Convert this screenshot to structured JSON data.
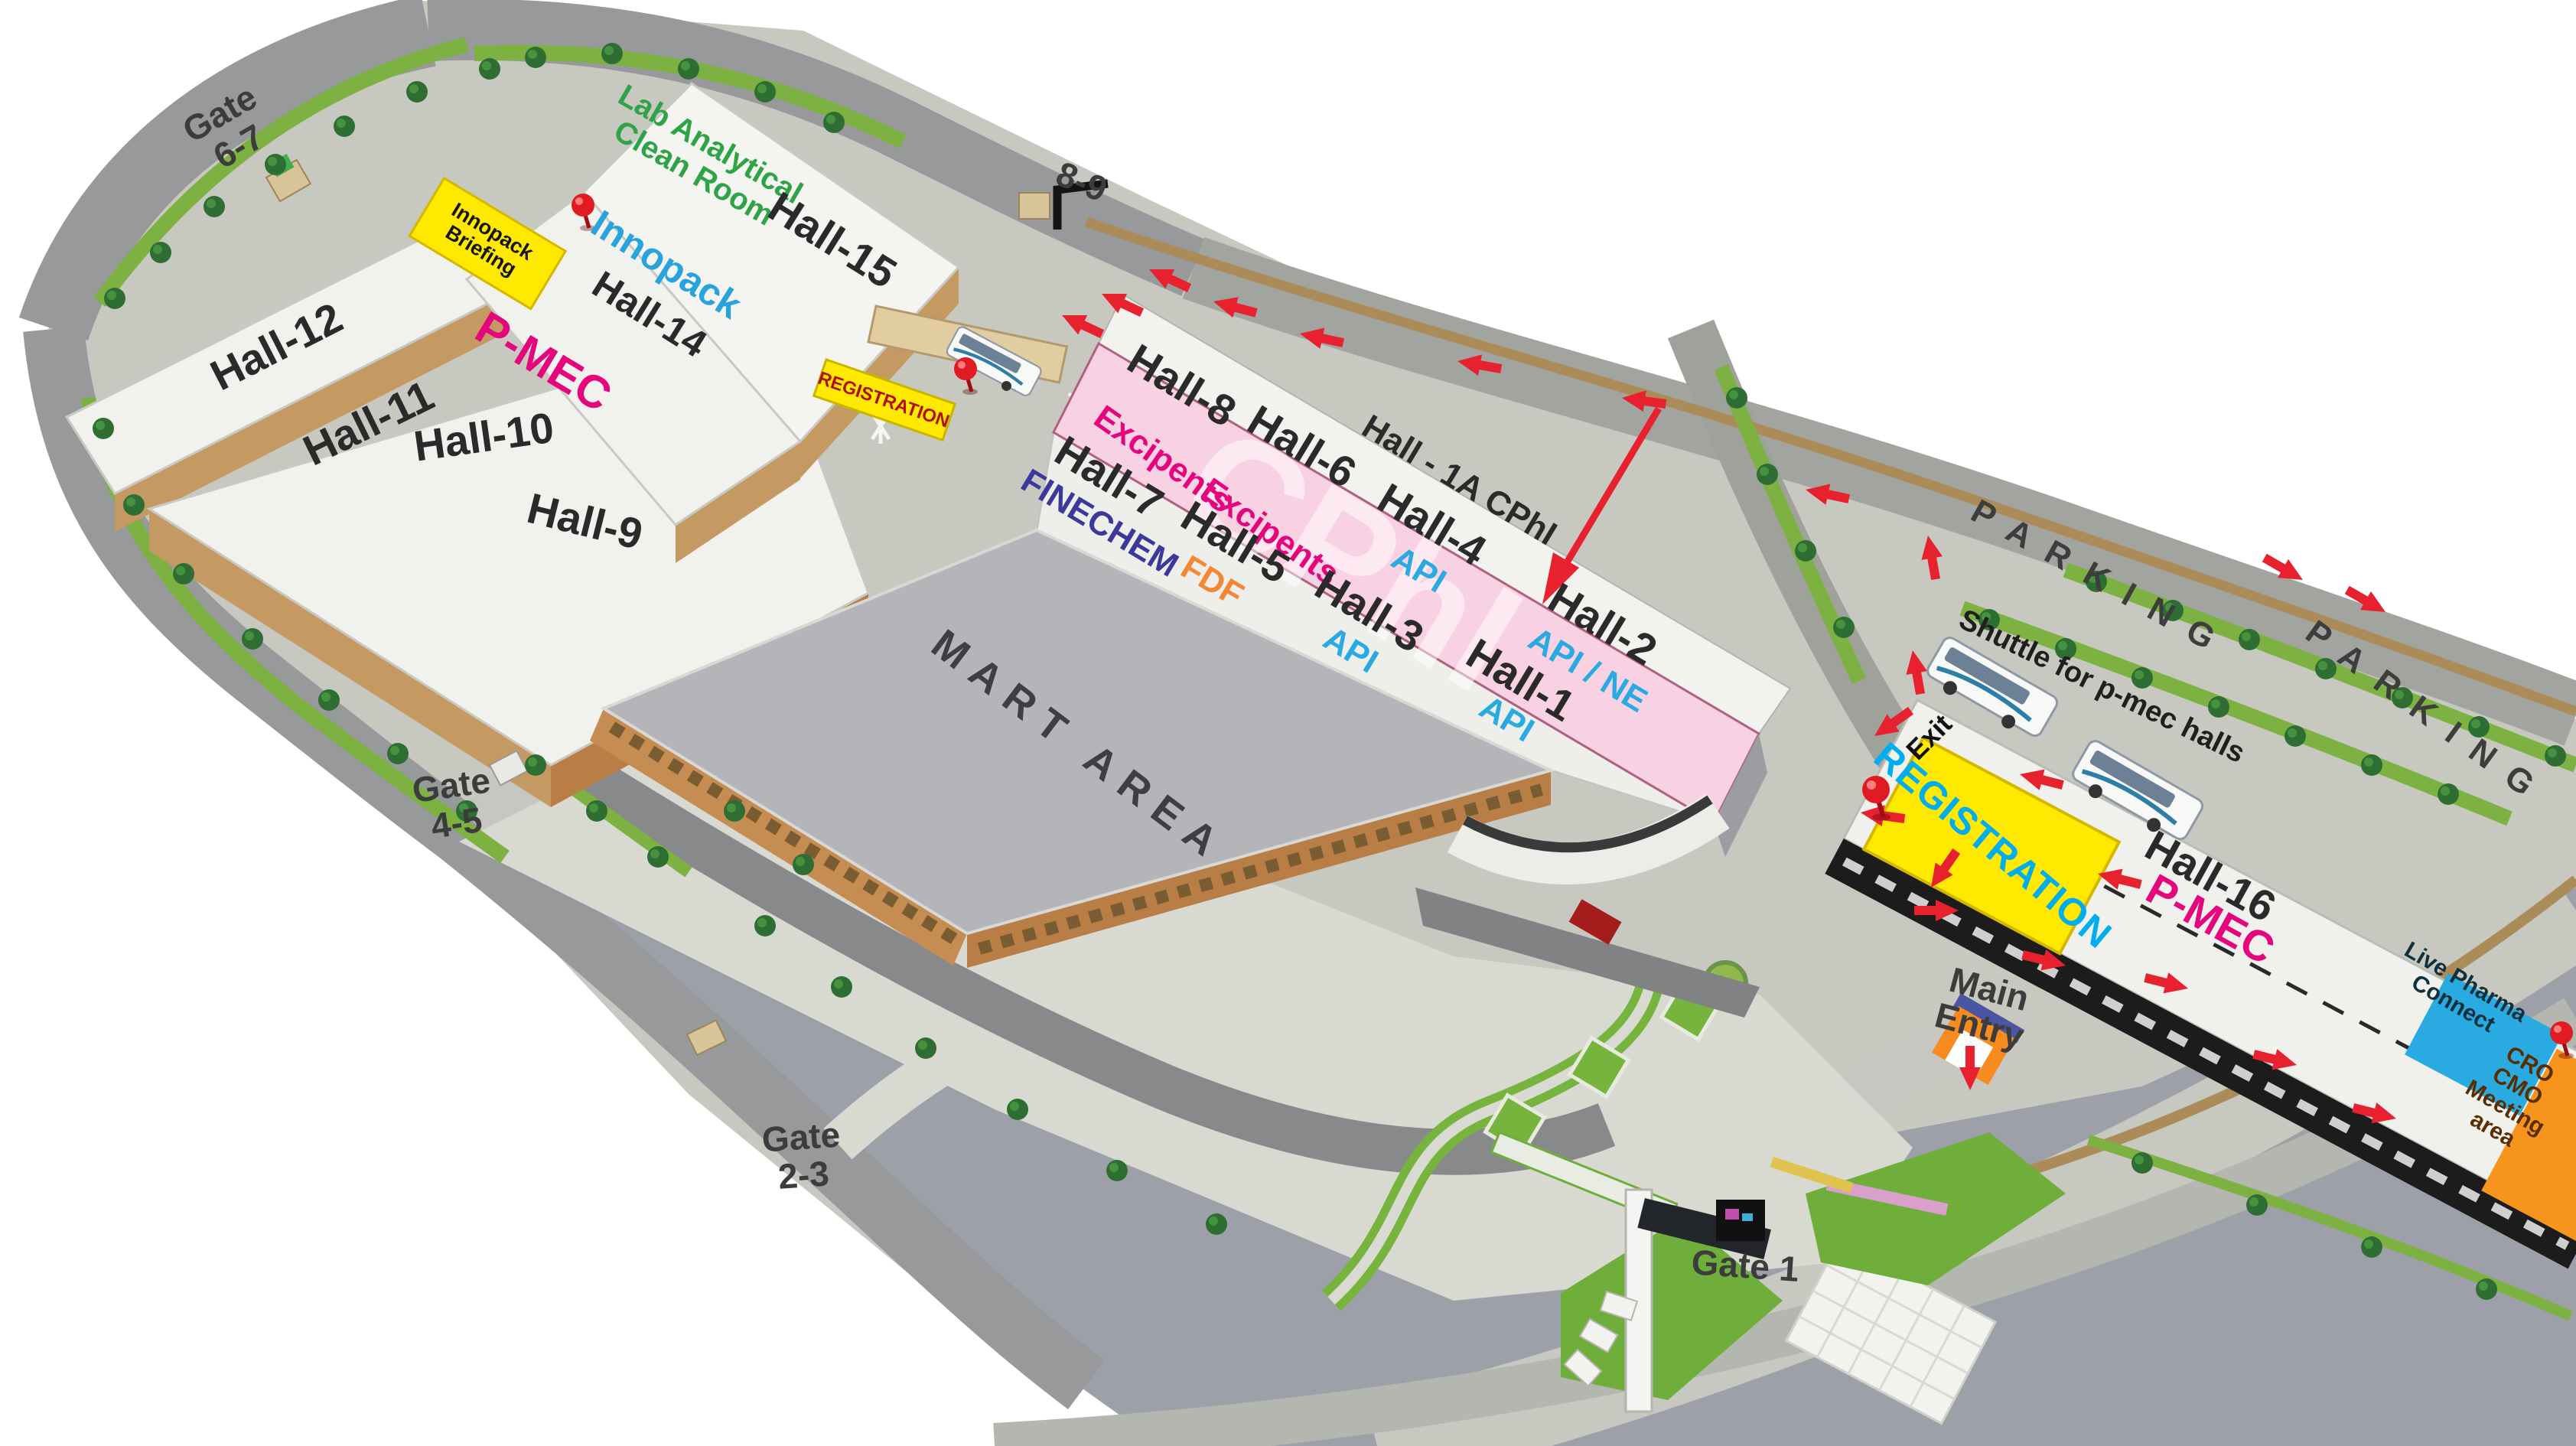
{
  "watermark": "CPhI",
  "halls": {
    "h1": {
      "name": "Hall-1",
      "category": "API"
    },
    "h1a": {
      "name": "Hall - 1A CPhI"
    },
    "h2": {
      "name": "Hall-2",
      "category": "API / NE"
    },
    "h3": {
      "name": "Hall-3",
      "category": "API"
    },
    "h4": {
      "name": "Hall-4",
      "category": "API"
    },
    "h5": {
      "name": "Hall-5",
      "category": "FDF"
    },
    "h6": {
      "name": "Hall-6",
      "category": "Excipents"
    },
    "h7": {
      "name": "Hall-7",
      "category": "FINECHEM"
    },
    "h8": {
      "name": "Hall-8",
      "category": "Excipents"
    },
    "h9": {
      "name": "Hall-9"
    },
    "h10": {
      "name": "Hall-10"
    },
    "h11": {
      "name": "Hall-11"
    },
    "h12": {
      "name": "Hall-12"
    },
    "h14": {
      "name": "Hall-14",
      "brand": "Innopack"
    },
    "h15": {
      "name": "Hall-15",
      "facility_lines": [
        "Lab Analytical",
        "Clean Room"
      ]
    },
    "h16": {
      "name": "Hall-16",
      "brand": "P-MEC"
    }
  },
  "zones": {
    "pmec_left": "P-MEC",
    "mart_area": "MART AREA",
    "registration_main": "REGISTRATION",
    "registration_gate": "REGISTRATION",
    "innopack_briefing_lines": [
      "Innopack",
      "Briefing"
    ],
    "live_pharma_lines": [
      "Live Pharma",
      "Connect"
    ],
    "cro_cmo_lines": [
      "CRO",
      "CMO",
      "Meeting",
      "area"
    ]
  },
  "gates": {
    "g67_lines": [
      "Gate",
      "6-7"
    ],
    "g89": "8-9",
    "g45_lines": [
      "Gate",
      "4-5"
    ],
    "g23_lines": [
      "Gate",
      "2-3"
    ],
    "g1": "Gate 1",
    "main_entry_lines": [
      "Main",
      "Entry"
    ],
    "exit": "Exit"
  },
  "parking": {
    "p1": "PARKING",
    "p2": "PARKING",
    "shuttle": "Shuttle for p-mec halls"
  },
  "colors": {
    "cphi_pink": "#f8d2e2",
    "magenta": "#e5067e",
    "api_blue": "#29abe2",
    "fdf_orange": "#f58634",
    "finechem_navy": "#3b3a9b",
    "innopack_blue": "#29a3dc",
    "lab_green": "#2fa347",
    "registration_yellow": "#ffe900",
    "registration_cyan": "#00aeef",
    "registration_red": "#b01116",
    "live_pharma_blue": "#29abe2",
    "cro_cmo_orange": "#f7941d",
    "arrow_red": "#e8212e"
  }
}
